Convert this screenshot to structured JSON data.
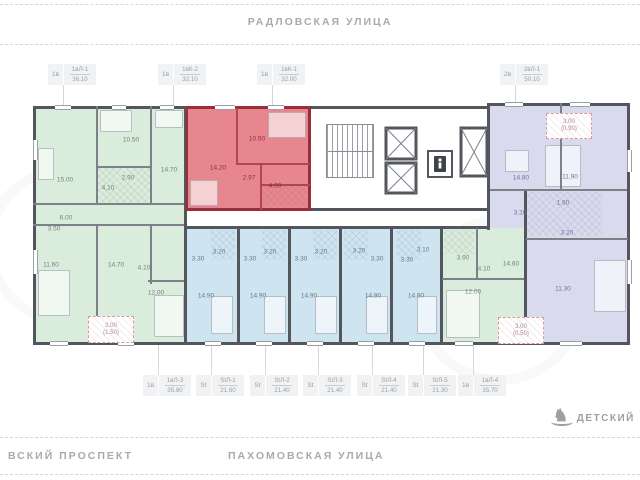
{
  "streets": {
    "top": "РАДЛОВСКАЯ УЛИЦА",
    "bottom_left": "ВСКИЙ ПРОСПЕКТ",
    "bottom_center": "ПАХОМОВСКАЯ УЛИЦА"
  },
  "poi": {
    "label": "ДЕТСКИЙ",
    "icon": "rocking-horse"
  },
  "colors": {
    "wall": "#53565c",
    "green_fill": "#daecdc",
    "blue_fill": "#cfe4f1",
    "purple_fill": "#d9daee",
    "highlight_fill": "#e8868f",
    "highlight_wall": "#9b2d3b",
    "label_gray": "#98a1a8"
  },
  "tags_top": [
    {
      "type": "1в",
      "code": "1вЛ-1",
      "area": "36.10",
      "x": 48,
      "y": 64,
      "leader_to": 106
    },
    {
      "type": "1в",
      "code": "1вК-2",
      "area": "32.10",
      "x": 158,
      "y": 64,
      "leader_to": 106
    },
    {
      "type": "1в",
      "code": "1вК-1",
      "area": "32.00",
      "x": 257,
      "y": 64,
      "leader_to": 106
    },
    {
      "type": "2в",
      "code": "2вЛ-1",
      "area": "50.10",
      "x": 500,
      "y": 64,
      "leader_to": 103
    }
  ],
  "tags_bottom": [
    {
      "type": "1в",
      "code": "1вЛ-3",
      "area": "35.80",
      "x": 143,
      "y": 375
    },
    {
      "type": "St",
      "code": "StЛ-1",
      "area": "21.60",
      "x": 196,
      "y": 375
    },
    {
      "type": "St",
      "code": "StЛ-2",
      "area": "21.40",
      "x": 250,
      "y": 375
    },
    {
      "type": "St",
      "code": "StЛ-3",
      "area": "21.40",
      "x": 303,
      "y": 375
    },
    {
      "type": "St",
      "code": "StЛ-4",
      "area": "21.40",
      "x": 357,
      "y": 375
    },
    {
      "type": "St",
      "code": "StЛ-5",
      "area": "21.30",
      "x": 408,
      "y": 375
    },
    {
      "type": "1в",
      "code": "1вЛ-4",
      "area": "35.70",
      "x": 458,
      "y": 375
    }
  ],
  "rooms": [
    {
      "t": "15.00",
      "x": 65,
      "y": 180,
      "c": "g"
    },
    {
      "t": "10.50",
      "x": 131,
      "y": 140,
      "c": "g"
    },
    {
      "t": "2.90",
      "x": 128,
      "y": 178,
      "c": "g"
    },
    {
      "t": "4.10",
      "x": 108,
      "y": 188,
      "c": "g"
    },
    {
      "t": "14.70",
      "x": 169,
      "y": 170,
      "c": "g"
    },
    {
      "t": "6.00",
      "x": 66,
      "y": 218,
      "c": "g"
    },
    {
      "t": "3.50",
      "x": 54,
      "y": 229,
      "c": "g"
    },
    {
      "t": "11.60",
      "x": 51,
      "y": 265,
      "c": "g"
    },
    {
      "t": "14.70",
      "x": 116,
      "y": 265,
      "c": "g"
    },
    {
      "t": "4.10",
      "x": 144,
      "y": 268,
      "c": "g"
    },
    {
      "t": "12.00",
      "x": 156,
      "y": 293,
      "c": "g"
    },
    {
      "t": "14.20",
      "x": 218,
      "y": 168,
      "c": "r"
    },
    {
      "t": "10.50",
      "x": 257,
      "y": 139,
      "c": "r"
    },
    {
      "t": "2.97",
      "x": 249,
      "y": 178,
      "c": "r"
    },
    {
      "t": "4.00",
      "x": 275,
      "y": 186,
      "c": "r"
    },
    {
      "t": "3.30",
      "x": 198,
      "y": 259,
      "c": "b"
    },
    {
      "t": "3.20",
      "x": 219,
      "y": 252,
      "c": "b"
    },
    {
      "t": "14.90",
      "x": 206,
      "y": 296,
      "c": "b"
    },
    {
      "t": "3.30",
      "x": 250,
      "y": 259,
      "c": "b"
    },
    {
      "t": "3.20",
      "x": 270,
      "y": 252,
      "c": "b"
    },
    {
      "t": "14.90",
      "x": 258,
      "y": 296,
      "c": "b"
    },
    {
      "t": "3.30",
      "x": 301,
      "y": 259,
      "c": "b"
    },
    {
      "t": "3.20",
      "x": 321,
      "y": 252,
      "c": "b"
    },
    {
      "t": "14.90",
      "x": 309,
      "y": 296,
      "c": "b"
    },
    {
      "t": "3.20",
      "x": 359,
      "y": 251,
      "c": "b"
    },
    {
      "t": "3.30",
      "x": 377,
      "y": 259,
      "c": "b"
    },
    {
      "t": "14.90",
      "x": 373,
      "y": 296,
      "c": "b"
    },
    {
      "t": "3.30",
      "x": 407,
      "y": 260,
      "c": "b"
    },
    {
      "t": "3.10",
      "x": 423,
      "y": 250,
      "c": "b"
    },
    {
      "t": "14.90",
      "x": 416,
      "y": 296,
      "c": "b"
    },
    {
      "t": "3.90",
      "x": 463,
      "y": 258,
      "c": "g"
    },
    {
      "t": "4.10",
      "x": 484,
      "y": 269,
      "c": "g"
    },
    {
      "t": "14.60",
      "x": 511,
      "y": 264,
      "c": "g"
    },
    {
      "t": "12.00",
      "x": 473,
      "y": 292,
      "c": "g"
    },
    {
      "t": "14.80",
      "x": 521,
      "y": 178,
      "c": "p"
    },
    {
      "t": "11.90",
      "x": 570,
      "y": 177,
      "c": "p"
    },
    {
      "t": "3.20",
      "x": 520,
      "y": 213,
      "c": "p"
    },
    {
      "t": "1.60",
      "x": 563,
      "y": 203,
      "c": "p"
    },
    {
      "t": "3.20",
      "x": 567,
      "y": 233,
      "c": "p"
    },
    {
      "t": "11.30",
      "x": 563,
      "y": 289,
      "c": "p"
    }
  ],
  "balconies": [
    {
      "l1": "3.00",
      "l2": "(0.90)",
      "x": 546,
      "y": 113,
      "w": 44,
      "h": 24
    },
    {
      "l1": "3.00",
      "l2": "(1.50)",
      "x": 88,
      "y": 316,
      "w": 44,
      "h": 25
    },
    {
      "l1": "3.00",
      "l2": "(0.50)",
      "x": 498,
      "y": 317,
      "w": 44,
      "h": 25
    }
  ]
}
